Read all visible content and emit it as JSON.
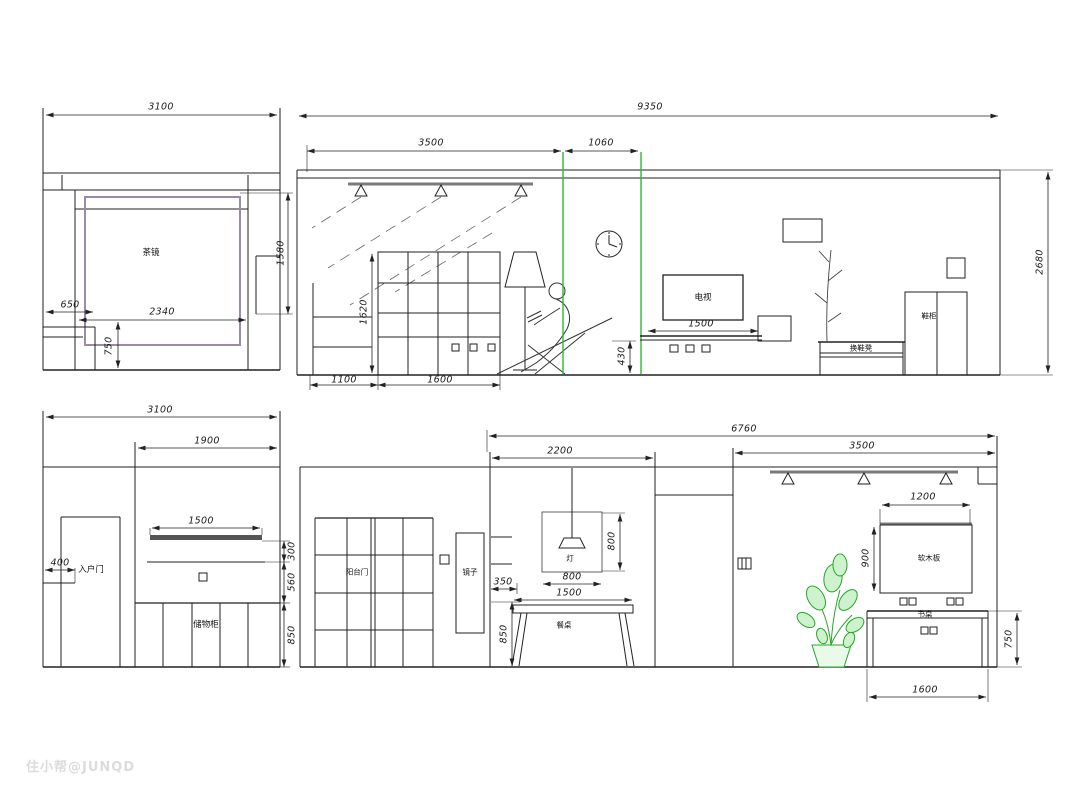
{
  "watermark": {
    "text": "住小帮@JUNQD"
  },
  "colors": {
    "line": "#222222",
    "accent_green": "#2db92d",
    "mirror_purple": "#9b89a8",
    "bar_gray": "#7a7a7a"
  },
  "elevation_dining_mirror": {
    "labels": {
      "mirror": "茶镜"
    },
    "dims": {
      "total_width": "3100",
      "mirror_height": "1580",
      "left_offset": "650",
      "mirror_width": "2340",
      "counter_height": "750"
    }
  },
  "elevation_living": {
    "labels": {
      "tv": "电视",
      "shoe_bench": "换鞋凳",
      "shoe_cabinet": "鞋柜"
    },
    "dims": {
      "total_width": "9350",
      "ceiling_seg_left": "3500",
      "ceiling_seg_right": "1060",
      "wall_height": "2680",
      "bookshelf_height": "1620",
      "cabinet_width": "1100",
      "bookshelf_width": "1600",
      "chaise_height": "430",
      "tv_bench_width": "1500"
    }
  },
  "elevation_entry": {
    "labels": {
      "entry_door": "入户门",
      "cabinet": "储物柜"
    },
    "dims": {
      "total_width": "3100",
      "right_section_width": "1900",
      "shelf_width": "1500",
      "door_offset": "400",
      "gap_300": "300",
      "gap_560": "560",
      "cabinet_height": "850"
    }
  },
  "elevation_balcony_dining": {
    "labels": {
      "balcony_door": "阳台门",
      "mirror": "镜子",
      "pendant": "灯",
      "table": "餐桌"
    },
    "dims": {
      "dining_width": "2200",
      "wall_return": "350",
      "shelf_height": "850",
      "pendant_height": "800",
      "pendant_width": "800",
      "table_width": "1500"
    }
  },
  "elevation_study": {
    "labels": {
      "cork_board": "软木板",
      "desk": "书桌"
    },
    "dims": {
      "total_width": "6760",
      "study_width": "3500",
      "board_width": "1200",
      "board_height": "900",
      "desk_height": "750",
      "desk_width": "1600"
    }
  }
}
